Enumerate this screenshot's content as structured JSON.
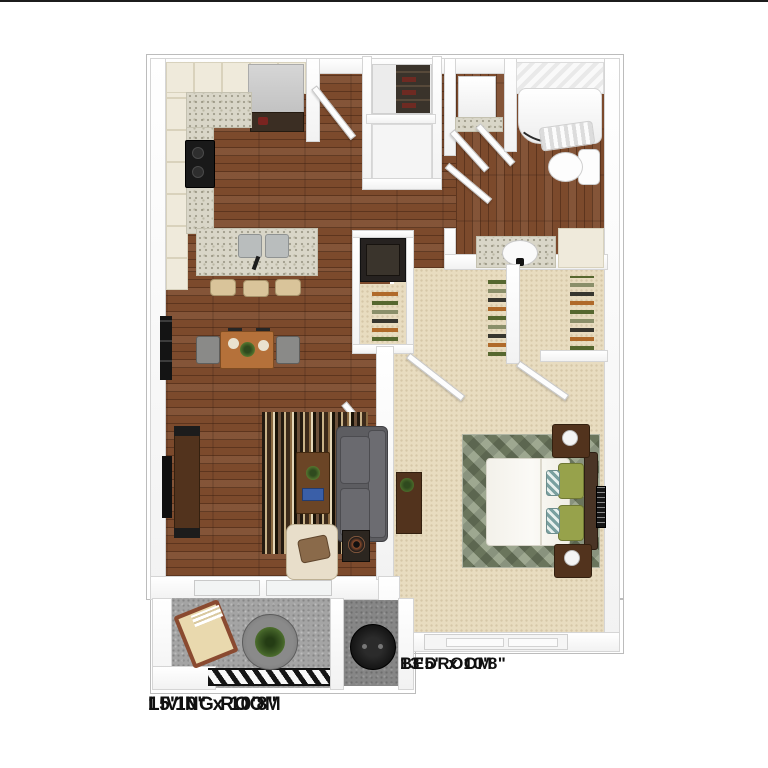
{
  "floor_plan": {
    "living_room": {
      "title": "LIVING ROOM",
      "dimensions": "15'10\" x 10'8\""
    },
    "bedroom": {
      "title": "BEDROOM",
      "dimensions": "13'5\" x 10'8\""
    },
    "colors": {
      "wood_floor": "#7c4a2c",
      "bedroom_carpet": "#e8dcc0",
      "countertop_granite": "#d9d6c8",
      "balcony_concrete": "#a4a4a4",
      "wall": "#fafafa",
      "sofa_gray": "#616165",
      "rug_sage": "#87907a",
      "furniture_dark_wood": "#52331d",
      "label_text": "#101010"
    }
  }
}
